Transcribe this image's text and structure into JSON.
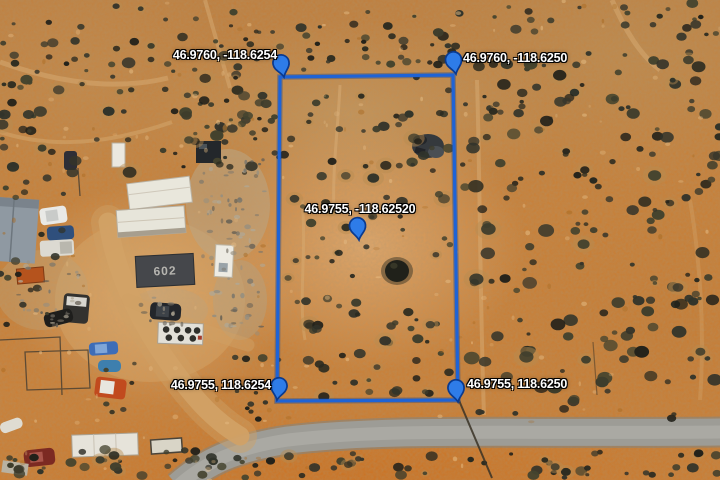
{
  "overlay": {
    "boundary_color": "#1e63d6",
    "pin_color": "#2e7ce8",
    "pin_outline_color": "#0a3a8f",
    "icons": {
      "corner_marker": "map-pin"
    },
    "labels": {
      "top_left": "46.9760, -118.6254",
      "top_right": "46.9760, -118.6250",
      "center": "46.9755, -118.62520",
      "bottom_left": "46.9755, 118.6254",
      "bottom_right": "46.9755, 118.6250"
    }
  },
  "ground": {
    "building_602_label": "602"
  }
}
